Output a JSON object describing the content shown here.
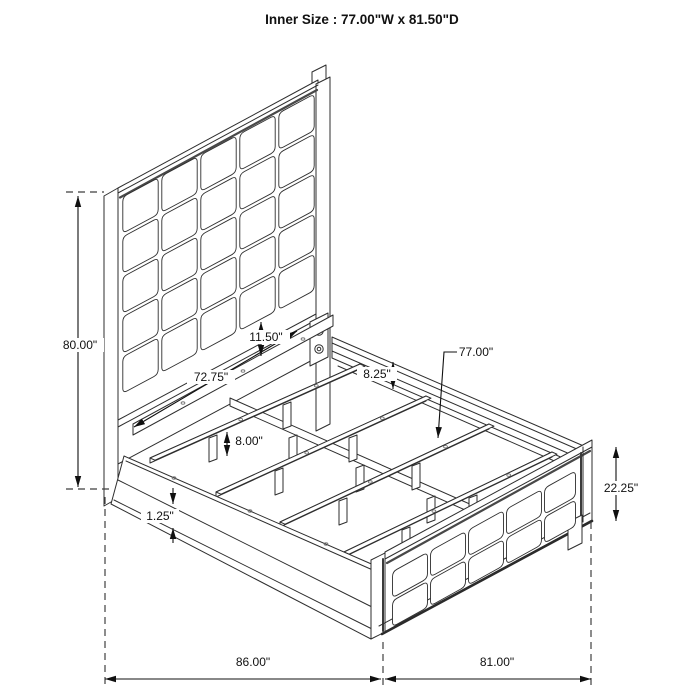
{
  "title": "Inner Size : 77.00\"W x 81.50\"D",
  "dimensions": {
    "headboard_height": "80.00\"",
    "headboard_to_slat": "11.50\"",
    "rail_inner_length": "72.75\"",
    "rail_height": "8.25\"",
    "slat_length": "77.00\"",
    "slat_leg_height": "8.00\"",
    "trim_thickness": "1.25\"",
    "footboard_height": "22.25\"",
    "overall_depth": "86.00\"",
    "overall_width": "81.00\""
  },
  "colors": {
    "line": "#2e2e2e",
    "dimension": "#111111",
    "dashed": "#3f3f3f",
    "shadow": "#484848",
    "background": "#ffffff"
  }
}
